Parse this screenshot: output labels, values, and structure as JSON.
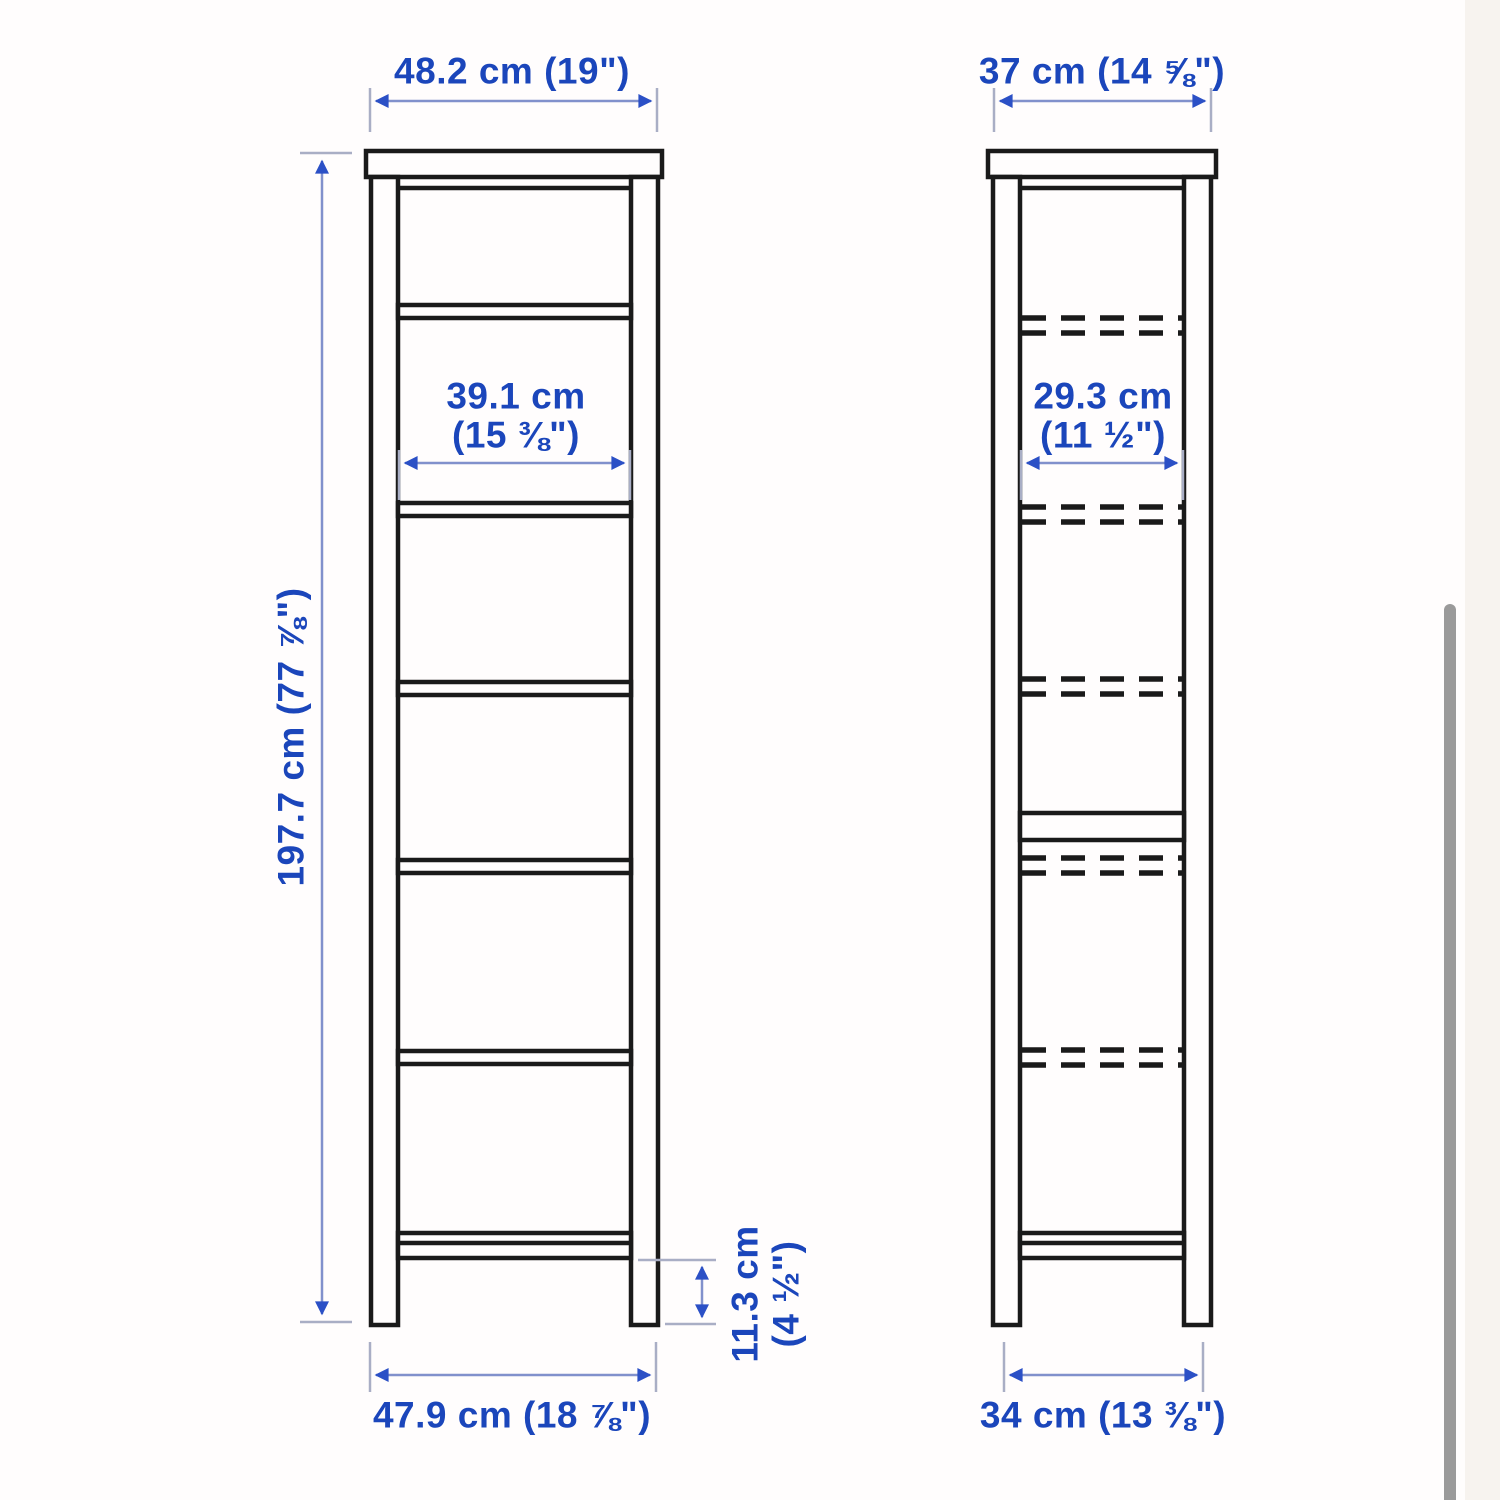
{
  "page": {
    "background_color": "#fffdfd",
    "side_panel_color": "#f7f3ef",
    "scrollbar_color": "#9a9a9a"
  },
  "colors": {
    "dimension_text": "#1b46bb",
    "dimension_line": "#8191cc",
    "arrowhead": "#2b50c6",
    "extension_line": "#a9aec5",
    "furniture_outline": "#1a1a1a"
  },
  "dimensions": {
    "front_top_width": "48.2 cm (19\")",
    "side_top_width": "37 cm (14 ⅝\")",
    "front_inner_width_line1": "39.1 cm",
    "front_inner_width_line2": "(15 ⅜\")",
    "side_inner_width_line1": "29.3 cm",
    "side_inner_width_line2": "(11 ½\")",
    "height": "197.7 cm (77 ⅞\")",
    "base_clearance_line1": "11.3 cm",
    "base_clearance_line2": "(4 ½\")",
    "front_base_width": "47.9 cm (18 ⅞\")",
    "side_base_width": "34 cm (13 ⅜\")"
  }
}
